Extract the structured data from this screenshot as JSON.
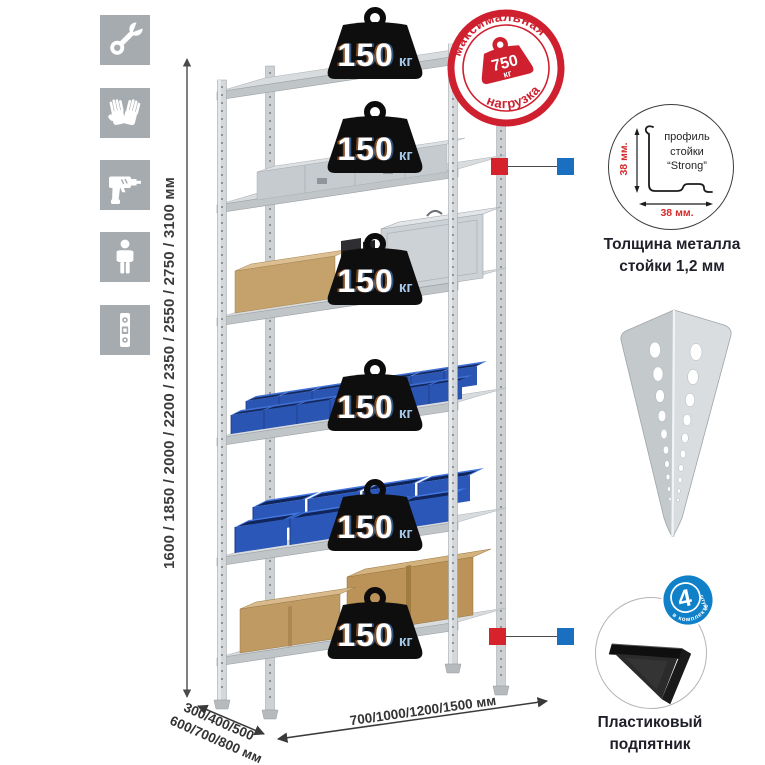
{
  "icon_rail": {
    "items": [
      {
        "name": "wrench"
      },
      {
        "name": "gloves"
      },
      {
        "name": "drill"
      },
      {
        "name": "person"
      },
      {
        "name": "spirit-level"
      }
    ]
  },
  "dimensions": {
    "height_label": "1600 / 1850 / 2000 / 2200 / 2350 / 2550 / 2750 / 3100 мм",
    "depth_line1": "300/400/500",
    "depth_line2": "600/700/800 мм",
    "width_label": "700/1000/1200/1500 мм"
  },
  "shelf_badges": [
    {
      "value": "150",
      "unit": "кг"
    },
    {
      "value": "150",
      "unit": "кг"
    },
    {
      "value": "150",
      "unit": "кг"
    },
    {
      "value": "150",
      "unit": "кг"
    },
    {
      "value": "150",
      "unit": "кг"
    },
    {
      "value": "150",
      "unit": "кг"
    }
  ],
  "max_load_stamp": {
    "arc_top": "максимальная",
    "arc_bottom": "нагрузка",
    "value": "750",
    "unit": "кг"
  },
  "profile_callout": {
    "text_line1": "профиль",
    "text_line2": "стойки",
    "text_line3": "“Strong”",
    "dim_vertical": "38 мм.",
    "dim_horizontal": "38 мм."
  },
  "profile_caption": {
    "line1": "Толщина металла",
    "line2": "стойки 1,2 мм"
  },
  "foot_caption": {
    "line1": "Пластиковый",
    "line2": "подпятник"
  },
  "kit_badge": {
    "number": "4",
    "word": "штуки",
    "arc": "в комплекте"
  },
  "colors": {
    "accent_red": "#cf2030",
    "accent_blue": "#1b6fc0",
    "bin_blue": "#2b55b2",
    "cardboard": "#c09a63",
    "metal_gray": "#a6abaf"
  }
}
